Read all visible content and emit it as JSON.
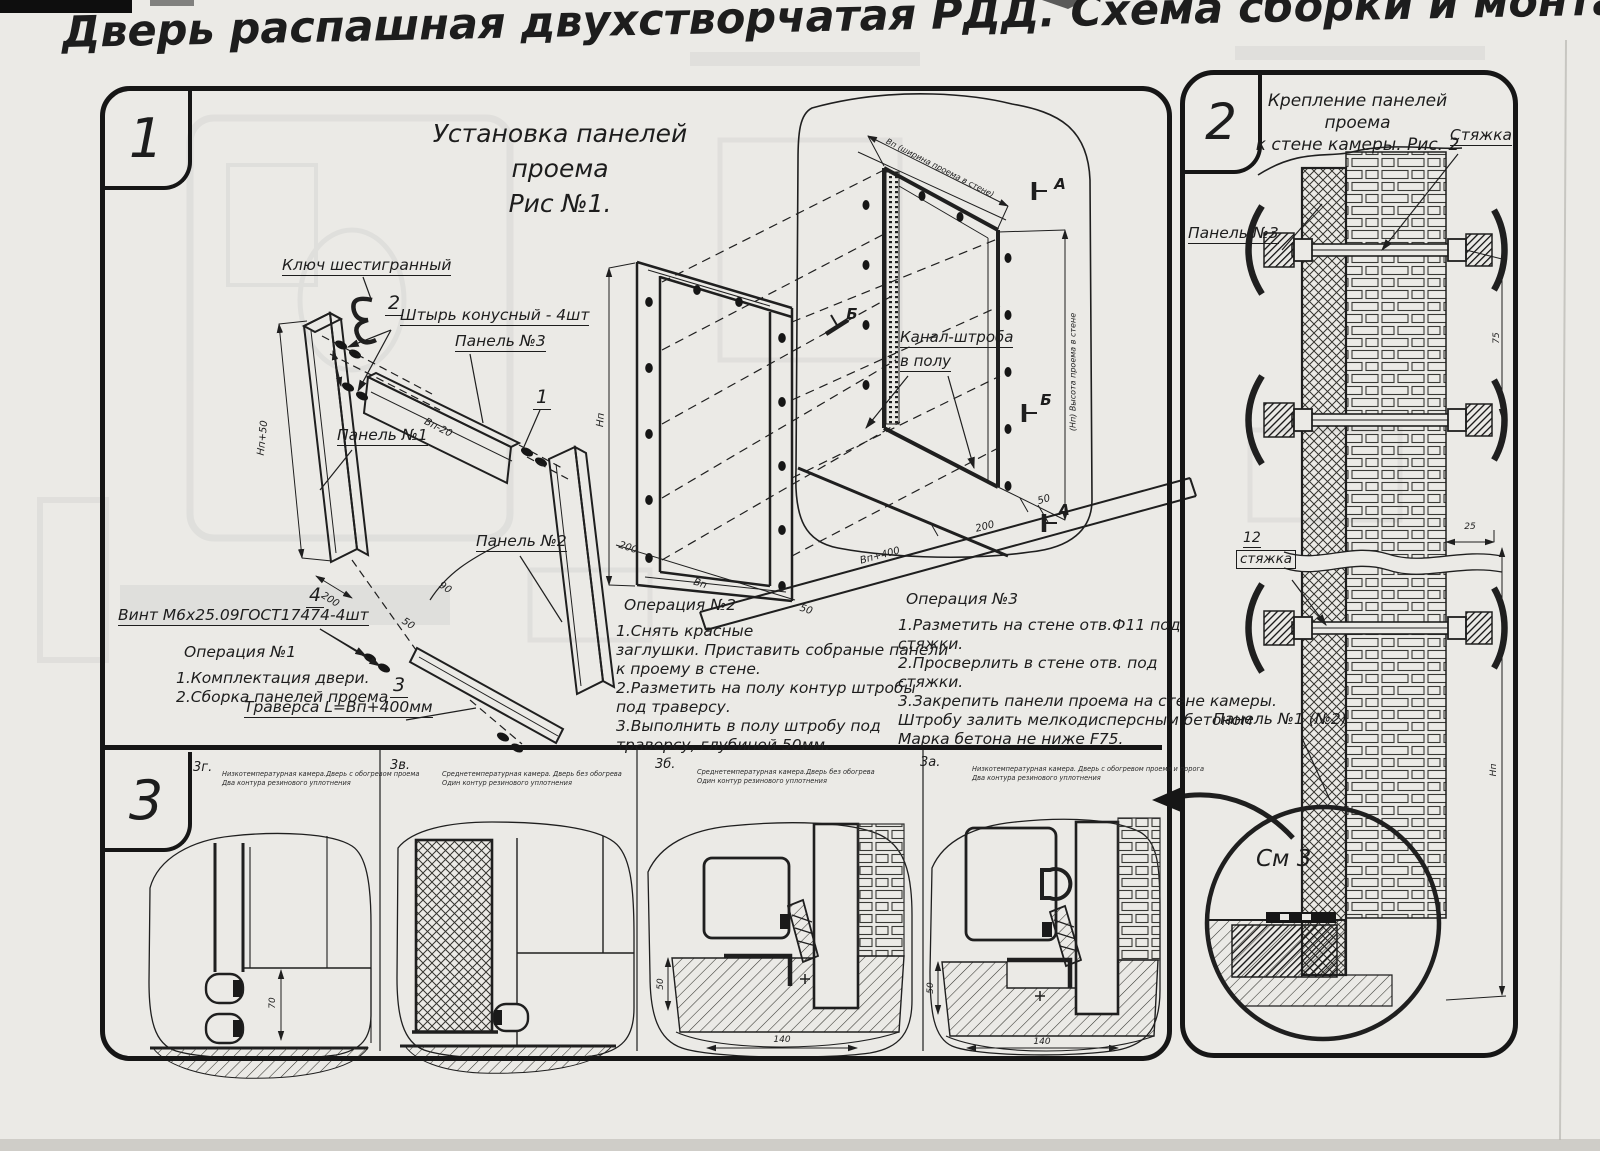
{
  "title": "Дверь распашная двухстворчатая РДД.  Схема сборки и монтажа №2",
  "s1": {
    "badge": "1",
    "fig1": "Установка панелей проема",
    "fig2": "Рис №1.",
    "lbl": {
      "key": "Ключ шестигранный",
      "pin_no": "2",
      "pin": "Штырь конусный - 4шт",
      "p3": "Панель №3",
      "p1": "Панель №1",
      "p2": "Панель №2",
      "c1": "1",
      "screw_no": "4",
      "screw": "Винт М6х25.09ГОСТ17474-4шт",
      "trav_no": "3",
      "trav": "Траверса  L=Bп+400мм",
      "chan1": "Канал-штроба",
      "chan2": "в полу",
      "a": "А",
      "b": "Б"
    },
    "dim": {
      "np50": "Нп+50",
      "d200": "200",
      "vp20": "Вп-20",
      "d90": "90",
      "d50": "50",
      "np": "Нп",
      "vp": "Вп",
      "vp400": "Вп+400",
      "top": "Вп (ширина проема в стене)",
      "right": "(Нп) Высота проема в стене"
    },
    "op1": {
      "t": "Операция №1",
      "l1": "1.Комплектация двери.",
      "l2": "2.Сборка панелей проема"
    },
    "op2": {
      "t": "Операция №2",
      "l1": "1.Снять красные",
      "l2": "заглушки. Приставить собраные панели",
      "l3": "к проему в стене.",
      "l4": "2.Разметить на полу контур штробы",
      "l5": "под траверсу.",
      "l6": "3.Выполнить в полу штробу под",
      "l7": "траверсу, глубиной 50мм."
    },
    "op3": {
      "t": "Операция №3",
      "l1": "1.Разметить на стене отв.Ф11 под",
      "l2": "стяжки.",
      "l3": "2.Просверлить в стене отв.  под",
      "l4": "стяжки.",
      "l5": "3.Закрепить панели проема на стене камеры.",
      "l6": "Штробу залить мелкодисперсным бетоном",
      "l7": "Марка бетона не ниже  F75."
    }
  },
  "s2": {
    "badge": "2",
    "fig1": "Крепление панелей проема",
    "fig2": "к стене камеры. Рис. 2",
    "lbl": {
      "tie": "Стяжка",
      "p3": "Панель №3",
      "no12": "12",
      "tie2": "стяжка",
      "p12": "Панель №1 (№2)",
      "see": "См 3"
    },
    "dim": {
      "d25": "25",
      "d75": "75",
      "np": "Нп"
    }
  },
  "s3": {
    "badge": "3",
    "details": [
      {
        "id": "3г.",
        "c1": "Низкотемпературная камера.Дверь с обогревом проема",
        "c2": "Два контура резинового уплотнения",
        "dv": "70"
      },
      {
        "id": "3в.",
        "c1": "Среднетемпературная камера. Дверь без обогрева",
        "c2": "Один контур резинового уплотнения"
      },
      {
        "id": "3б.",
        "c1": "Среднетемпературная камера.Дверь без обогрева",
        "c2": "Один контур резинового уплотнения",
        "dv": "50",
        "dh": "140"
      },
      {
        "id": "3а.",
        "c1": "Низкотемпературная камера. Дверь с обогревом проема и порога",
        "c2": "Два контура резинового уплотнения",
        "dv": "50",
        "dh": "140"
      }
    ]
  }
}
